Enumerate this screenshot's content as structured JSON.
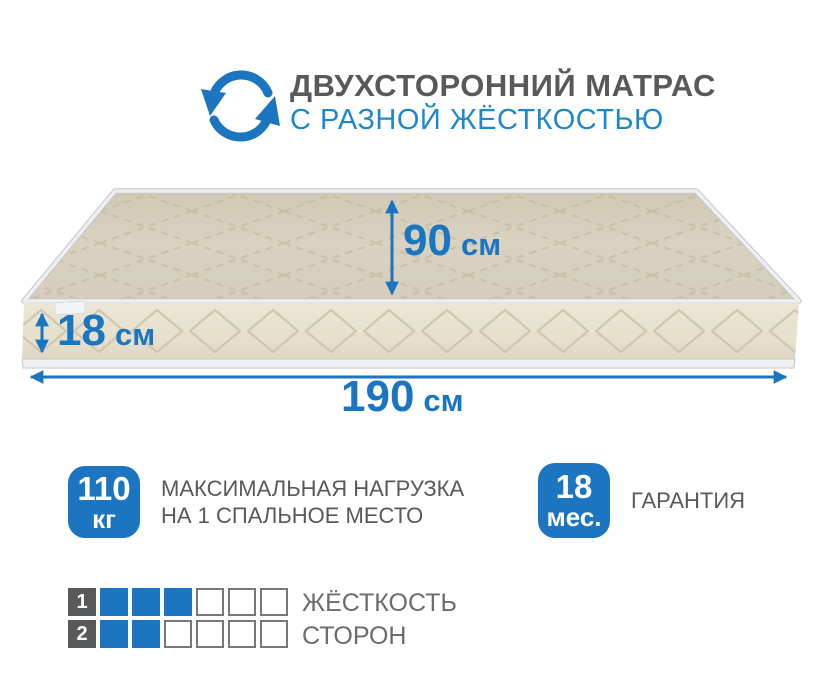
{
  "header": {
    "title": "ДВУХСТОРОННИЙ МАТРАС",
    "subtitle": "С РАЗНОЙ ЖЁСТКОСТЬЮ",
    "icon": "rotate-arrows-icon"
  },
  "mattress": {
    "dimensions": {
      "width": {
        "value": "90",
        "unit": "см"
      },
      "thickness": {
        "value": "18",
        "unit": "см"
      },
      "length": {
        "value": "190",
        "unit": "см"
      }
    }
  },
  "features": [
    {
      "badge_value": "110",
      "badge_unit": "кг",
      "label_line1": "МАКСИМАЛЬНАЯ НАГРУЗКА",
      "label_line2": "НА 1 СПАЛЬНОЕ МЕСТО"
    },
    {
      "badge_value": "18",
      "badge_unit": "мес.",
      "label_line1": "ГАРАНТИЯ"
    }
  ],
  "firmness": {
    "label_line1": "ЖЁСТКОСТЬ",
    "label_line2": "СТОРОН",
    "scale_max": 6,
    "rows": [
      {
        "side": "1",
        "filled": 3
      },
      {
        "side": "2",
        "filled": 2
      }
    ]
  },
  "colors": {
    "accent": "#1b75c0",
    "subtitleBlue": "#1e88cf",
    "titleGray": "#58595b",
    "labelGray": "#58595b",
    "mattressTop": "#d7d0bf",
    "mattressSide": "#e8e2d0",
    "piping": "#edeff0"
  }
}
